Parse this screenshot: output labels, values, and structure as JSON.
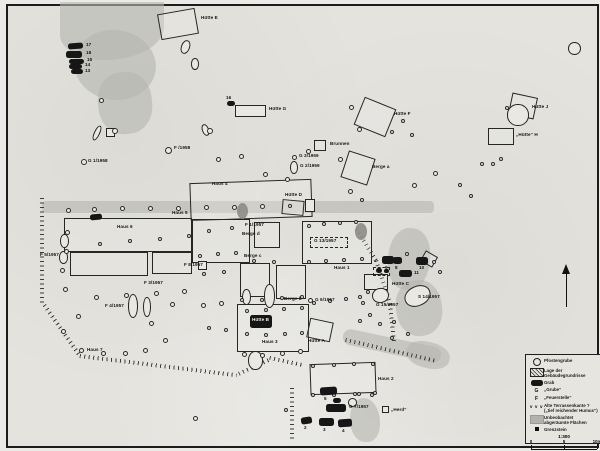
{
  "legend": {
    "entries": [
      {
        "sym": "circle",
        "label": "Pfostengrube"
      },
      {
        "sym": "hatch",
        "label": "Lage der\nGebäudegrundrisse"
      },
      {
        "sym": "grave",
        "label": "Grab"
      },
      {
        "sym": "g",
        "glyph": "G",
        "label": "„Grube“"
      },
      {
        "sym": "f",
        "glyph": "F",
        "label": "„Feuerstelle“"
      },
      {
        "sym": "vvv",
        "glyph": "v v v",
        "label": "Alte Terrassenkante ?\n(„tief reichender Humus“)"
      },
      {
        "sym": "gray",
        "label": "Unbeobachtet\nabgeräumte Flächen"
      },
      {
        "sym": "sq",
        "label": "Grenzstein"
      }
    ],
    "scale": {
      "ratio": "1:300",
      "ticks": [
        "0",
        "5",
        "10m"
      ]
    }
  },
  "map": {
    "gray_areas": [
      [
        58,
        0,
        104,
        58,
        0,
        "0 0 60% 45%"
      ],
      [
        72,
        28,
        82,
        70,
        8,
        "50%"
      ],
      [
        96,
        70,
        54,
        62,
        -6,
        "45%"
      ],
      [
        40,
        199,
        392,
        12,
        0,
        "4px"
      ],
      [
        386,
        226,
        42,
        62,
        6,
        "46%"
      ],
      [
        394,
        278,
        46,
        56,
        -8,
        "46%"
      ],
      [
        340,
        336,
        100,
        16,
        12,
        "8px"
      ],
      [
        404,
        340,
        44,
        26,
        14,
        "45%"
      ],
      [
        348,
        396,
        30,
        44,
        0,
        "45% 55% 40% 50%"
      ]
    ],
    "terrace_lines": [
      [
        42,
        196,
        108,
        90
      ],
      [
        44,
        302,
        62,
        55
      ],
      [
        78,
        352,
        158,
        7
      ],
      [
        236,
        370,
        36,
        -25
      ],
      [
        268,
        354,
        34,
        12
      ],
      [
        292,
        386,
        52,
        90
      ],
      [
        356,
        226,
        38,
        58
      ],
      [
        376,
        258,
        46,
        72
      ],
      [
        390,
        302,
        40,
        84
      ],
      [
        344,
        336,
        92,
        13
      ]
    ],
    "hatched": [
      [
        157,
        9,
        38,
        26,
        -10
      ],
      [
        249,
        103,
        15,
        12,
        0
      ],
      [
        356,
        100,
        34,
        30,
        22
      ],
      [
        508,
        93,
        26,
        22,
        12
      ],
      [
        486,
        126,
        26,
        17,
        0
      ],
      [
        312,
        138,
        12,
        11,
        0
      ],
      [
        342,
        152,
        28,
        28,
        18
      ],
      [
        188,
        179,
        122,
        38,
        -2
      ],
      [
        62,
        216,
        128,
        34,
        0
      ],
      [
        68,
        250,
        78,
        24,
        0
      ],
      [
        150,
        250,
        40,
        22,
        0
      ],
      [
        190,
        217,
        58,
        44,
        0
      ],
      [
        252,
        220,
        26,
        26,
        0
      ],
      [
        280,
        198,
        22,
        15,
        5
      ],
      [
        300,
        219,
        70,
        43,
        0
      ],
      [
        238,
        261,
        30,
        34,
        0
      ],
      [
        274,
        263,
        30,
        34,
        0
      ],
      [
        235,
        302,
        72,
        48,
        0
      ],
      [
        306,
        318,
        24,
        20,
        12
      ],
      [
        308,
        361,
        66,
        31,
        -2
      ],
      [
        362,
        272,
        24,
        16,
        0
      ],
      [
        420,
        251,
        14,
        12,
        30
      ]
    ],
    "outline_rects": [
      [
        233,
        103,
        31,
        12,
        0
      ],
      [
        196,
        259,
        9,
        9,
        0
      ],
      [
        380,
        404,
        7,
        7,
        0
      ],
      [
        303,
        197,
        10,
        13,
        0
      ],
      [
        104,
        126,
        9,
        9,
        0
      ]
    ],
    "dashed_boxes": [
      [
        308,
        235,
        38,
        11
      ],
      [
        371,
        265,
        17,
        9
      ]
    ],
    "dark_pits": [
      [
        235,
        201,
        11,
        16
      ],
      [
        353,
        221,
        12,
        17
      ]
    ],
    "pits": [
      [
        179,
        38,
        9,
        14,
        20
      ],
      [
        189,
        56,
        8,
        12,
        0
      ],
      [
        92,
        123,
        6,
        16,
        25
      ],
      [
        200,
        122,
        7,
        12,
        -20
      ],
      [
        288,
        159,
        8,
        13,
        0
      ],
      [
        57,
        249,
        9,
        13,
        0
      ],
      [
        58,
        232,
        9,
        14,
        0
      ],
      [
        126,
        292,
        10,
        24,
        0
      ],
      [
        141,
        295,
        8,
        20,
        0
      ],
      [
        262,
        282,
        11,
        24,
        0
      ],
      [
        240,
        287,
        9,
        16,
        0
      ],
      [
        370,
        286,
        17,
        15,
        -10
      ],
      [
        402,
        284,
        27,
        20,
        -25
      ],
      [
        246,
        349,
        15,
        19,
        0
      ],
      [
        505,
        102,
        22,
        22,
        0
      ],
      [
        566,
        40,
        13,
        13,
        0
      ],
      [
        346,
        396,
        9,
        9,
        0
      ]
    ],
    "circles": [
      [
        97,
        96,
        5
      ],
      [
        110,
        126,
        6
      ],
      [
        205,
        126,
        6
      ],
      [
        214,
        155,
        5
      ],
      [
        237,
        152,
        5
      ],
      [
        261,
        170,
        5
      ],
      [
        283,
        175,
        5
      ],
      [
        347,
        103,
        5
      ],
      [
        355,
        125,
        5
      ],
      [
        388,
        128,
        4
      ],
      [
        399,
        117,
        4
      ],
      [
        408,
        131,
        4
      ],
      [
        304,
        147,
        5
      ],
      [
        336,
        155,
        5
      ],
      [
        346,
        187,
        5
      ],
      [
        358,
        196,
        4
      ],
      [
        410,
        181,
        5
      ],
      [
        431,
        169,
        5
      ],
      [
        456,
        181,
        4
      ],
      [
        467,
        192,
        4
      ],
      [
        478,
        160,
        4
      ],
      [
        489,
        160,
        4
      ],
      [
        497,
        155,
        4
      ],
      [
        503,
        104,
        4
      ],
      [
        79,
        157,
        6
      ],
      [
        163,
        145,
        7
      ],
      [
        290,
        153,
        5
      ],
      [
        306,
        296,
        5
      ],
      [
        64,
        206,
        5
      ],
      [
        90,
        205,
        5
      ],
      [
        118,
        204,
        5
      ],
      [
        146,
        204,
        5
      ],
      [
        174,
        204,
        5
      ],
      [
        202,
        203,
        5
      ],
      [
        230,
        203,
        5
      ],
      [
        258,
        202,
        5
      ],
      [
        286,
        202,
        4
      ],
      [
        63,
        228,
        5
      ],
      [
        62,
        247,
        5
      ],
      [
        58,
        266,
        5
      ],
      [
        61,
        285,
        5
      ],
      [
        92,
        293,
        5
      ],
      [
        122,
        291,
        5
      ],
      [
        152,
        289,
        5
      ],
      [
        180,
        287,
        5
      ],
      [
        96,
        240,
        4
      ],
      [
        126,
        237,
        4
      ],
      [
        156,
        235,
        4
      ],
      [
        185,
        232,
        4
      ],
      [
        205,
        227,
        4
      ],
      [
        228,
        224,
        4
      ],
      [
        196,
        252,
        4
      ],
      [
        214,
        250,
        4
      ],
      [
        232,
        249,
        4
      ],
      [
        250,
        257,
        4
      ],
      [
        270,
        258,
        4
      ],
      [
        200,
        270,
        4
      ],
      [
        220,
        268,
        4
      ],
      [
        238,
        296,
        4
      ],
      [
        258,
        296,
        4
      ],
      [
        278,
        294,
        4
      ],
      [
        298,
        293,
        4
      ],
      [
        310,
        299,
        4
      ],
      [
        326,
        297,
        4
      ],
      [
        342,
        295,
        4
      ],
      [
        356,
        293,
        4
      ],
      [
        305,
        222,
        4
      ],
      [
        320,
        220,
        4
      ],
      [
        336,
        219,
        4
      ],
      [
        352,
        218,
        4
      ],
      [
        305,
        258,
        4
      ],
      [
        322,
        257,
        4
      ],
      [
        340,
        256,
        4
      ],
      [
        358,
        255,
        4
      ],
      [
        74,
        312,
        5
      ],
      [
        59,
        327,
        5
      ],
      [
        77,
        346,
        5
      ],
      [
        99,
        349,
        5
      ],
      [
        121,
        349,
        5
      ],
      [
        141,
        346,
        5
      ],
      [
        161,
        336,
        5
      ],
      [
        147,
        319,
        5
      ],
      [
        168,
        300,
        5
      ],
      [
        199,
        301,
        5
      ],
      [
        217,
        299,
        5
      ],
      [
        205,
        324,
        4
      ],
      [
        222,
        326,
        4
      ],
      [
        240,
        350,
        5
      ],
      [
        258,
        351,
        5
      ],
      [
        278,
        349,
        5
      ],
      [
        296,
        347,
        5
      ],
      [
        243,
        307,
        4
      ],
      [
        262,
        306,
        4
      ],
      [
        280,
        305,
        4
      ],
      [
        298,
        304,
        4
      ],
      [
        243,
        330,
        4
      ],
      [
        262,
        331,
        4
      ],
      [
        281,
        330,
        4
      ],
      [
        298,
        329,
        4
      ],
      [
        309,
        362,
        4
      ],
      [
        330,
        361,
        4
      ],
      [
        350,
        360,
        4
      ],
      [
        369,
        360,
        4
      ],
      [
        309,
        391,
        4
      ],
      [
        330,
        391,
        4
      ],
      [
        351,
        390,
        4
      ],
      [
        371,
        389,
        4
      ],
      [
        191,
        414,
        5
      ],
      [
        282,
        406,
        4
      ],
      [
        355,
        390,
        4
      ],
      [
        368,
        391,
        4
      ],
      [
        364,
        288,
        4
      ],
      [
        359,
        299,
        4
      ],
      [
        366,
        311,
        4
      ],
      [
        356,
        317,
        4
      ],
      [
        390,
        318,
        4
      ],
      [
        376,
        320,
        4
      ],
      [
        388,
        334,
        4
      ],
      [
        404,
        330,
        4
      ],
      [
        403,
        250,
        4
      ],
      [
        430,
        258,
        4
      ],
      [
        436,
        268,
        4
      ]
    ],
    "graves": [
      [
        66,
        41,
        15,
        6,
        -4
      ],
      [
        64,
        49,
        16,
        7,
        0
      ],
      [
        67,
        57,
        15,
        5,
        0
      ],
      [
        67,
        62,
        13,
        5,
        0
      ],
      [
        69,
        67,
        12,
        5,
        0
      ],
      [
        225,
        99,
        8,
        5,
        0
      ],
      [
        88,
        212,
        12,
        6,
        -5
      ],
      [
        380,
        254,
        12,
        8,
        0
      ],
      [
        391,
        255,
        9,
        7,
        0
      ],
      [
        414,
        255,
        12,
        8,
        0
      ],
      [
        397,
        268,
        13,
        7,
        0
      ],
      [
        374,
        266,
        6,
        5,
        0
      ],
      [
        382,
        267,
        5,
        4,
        0
      ],
      [
        248,
        313,
        22,
        13,
        0
      ],
      [
        318,
        385,
        17,
        8,
        -4
      ],
      [
        331,
        396,
        8,
        5,
        0
      ],
      [
        324,
        402,
        20,
        8,
        0
      ],
      [
        299,
        415,
        11,
        7,
        -8
      ],
      [
        317,
        416,
        15,
        8,
        0
      ],
      [
        336,
        417,
        14,
        8,
        -4
      ]
    ],
    "labels": [
      [
        "Hütte E",
        199,
        14,
        0
      ],
      [
        "17",
        84,
        41,
        0
      ],
      [
        "18",
        84,
        49,
        0
      ],
      [
        "15",
        85,
        56,
        0
      ],
      [
        "14",
        83,
        61,
        0
      ],
      [
        "13",
        83,
        67,
        0
      ],
      [
        "16",
        224,
        94,
        0
      ],
      [
        "Hütte G",
        267,
        105,
        0
      ],
      [
        "Hütte F",
        392,
        110,
        0
      ],
      [
        "Hütte J",
        530,
        103,
        0
      ],
      [
        "„Hütte“ H",
        514,
        131,
        0
      ],
      [
        "Brunnen",
        328,
        140,
        0
      ],
      [
        "G 3/1959",
        297,
        152,
        0
      ],
      [
        "G 2/1959",
        298,
        162,
        0
      ],
      [
        "Berge a",
        370,
        163,
        0
      ],
      [
        "F /1958",
        172,
        144,
        0
      ],
      [
        "G 1/1958",
        86,
        157,
        0
      ],
      [
        "Haus 4",
        210,
        180,
        0
      ],
      [
        "Hütte D",
        283,
        191,
        0
      ],
      [
        "Haus 5",
        170,
        209,
        0
      ],
      [
        "Haus 6",
        115,
        223,
        0
      ],
      [
        "F 1/1957",
        243,
        221,
        0
      ],
      [
        "Berge d",
        240,
        230,
        0
      ],
      [
        "G 13/1957",
        312,
        237,
        0
      ],
      [
        "Haus 1",
        332,
        264,
        0
      ],
      [
        "Berge c",
        242,
        252,
        0
      ],
      [
        "Berge b",
        282,
        295,
        0
      ],
      [
        "G 6/1957",
        313,
        296,
        0
      ],
      [
        "F 5/1957",
        38,
        251,
        0
      ],
      [
        "F 8/1957",
        182,
        261,
        0
      ],
      [
        "F 3/1957",
        142,
        279,
        0
      ],
      [
        "F 4/1957",
        103,
        302,
        0
      ],
      [
        "Haus 7",
        85,
        346,
        0
      ],
      [
        "Haus 3",
        260,
        338,
        0
      ],
      [
        "Hütte A",
        306,
        337,
        0
      ],
      [
        "Hütte B",
        250,
        316,
        1
      ],
      [
        "Hütte C",
        390,
        280,
        0
      ],
      [
        "11",
        412,
        269,
        0
      ],
      [
        "9",
        383,
        264,
        0
      ],
      [
        "8",
        393,
        264,
        0
      ],
      [
        "10",
        417,
        264,
        0
      ],
      [
        "G 15/1957",
        374,
        301,
        0
      ],
      [
        "S 14/1957",
        416,
        293,
        0
      ],
      [
        "Haus 2",
        376,
        375,
        0
      ],
      [
        "5",
        322,
        395,
        0
      ],
      [
        "6",
        332,
        398,
        0
      ],
      [
        "G 7/1957",
        347,
        403,
        0
      ],
      [
        "2",
        302,
        424,
        0
      ],
      [
        "3",
        321,
        426,
        0
      ],
      [
        "4",
        340,
        427,
        0
      ],
      [
        "„Herd“",
        389,
        406,
        0
      ]
    ]
  }
}
